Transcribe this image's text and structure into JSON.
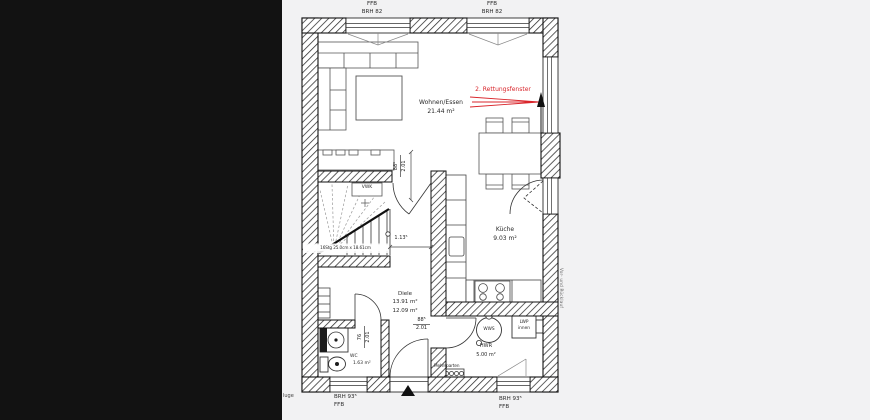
{
  "colors": {
    "accent_red": "#d9252b",
    "wall_line": "#141414",
    "background": "#f2f2f3",
    "letterbox": "#121212"
  },
  "windows": {
    "top_left": {
      "l1": "FFB",
      "l2": "BRH 82"
    },
    "top_right": {
      "l1": "FFB",
      "l2": "BRH 82"
    },
    "bottom_left": {
      "l1": "BRH 93⁵",
      "l2": "FFB"
    },
    "bottom_right": {
      "l1": "BRH 93⁵",
      "l2": "FFB"
    }
  },
  "rooms": {
    "living": {
      "name": "Wohnen/Essen",
      "area": "21.44 m²"
    },
    "kitchen": {
      "name": "Küche",
      "area": "9.03 m²"
    },
    "hall": {
      "name": "Diele",
      "area_a": "13.91 m²",
      "area_b": "12.09 m²"
    },
    "wc": {
      "name": "WC",
      "area": "1.63 m²"
    },
    "utility": {
      "name": "HWR",
      "area": "5.00 m²"
    }
  },
  "doors": {
    "living_hall": {
      "w": "88⁵",
      "h": "2.01"
    },
    "hall_hwr": {
      "w": "88⁵",
      "h": "2.01"
    },
    "wc": {
      "w": "76",
      "h": "2.01"
    }
  },
  "annotations": {
    "rescue_window": "2. Rettungsfenster",
    "stair_spec": "16Stg 25.0cm x 18.61cm",
    "duct": "VWK",
    "corridor_dim": "1.13⁵",
    "water_storage": "WWS",
    "heat_pump_l1": "LWP",
    "heat_pump_l2": "innen",
    "utility_connection": "Mehrsparten",
    "pipe_note": "Vor- und Rücklauf",
    "edge_text": "luge"
  }
}
